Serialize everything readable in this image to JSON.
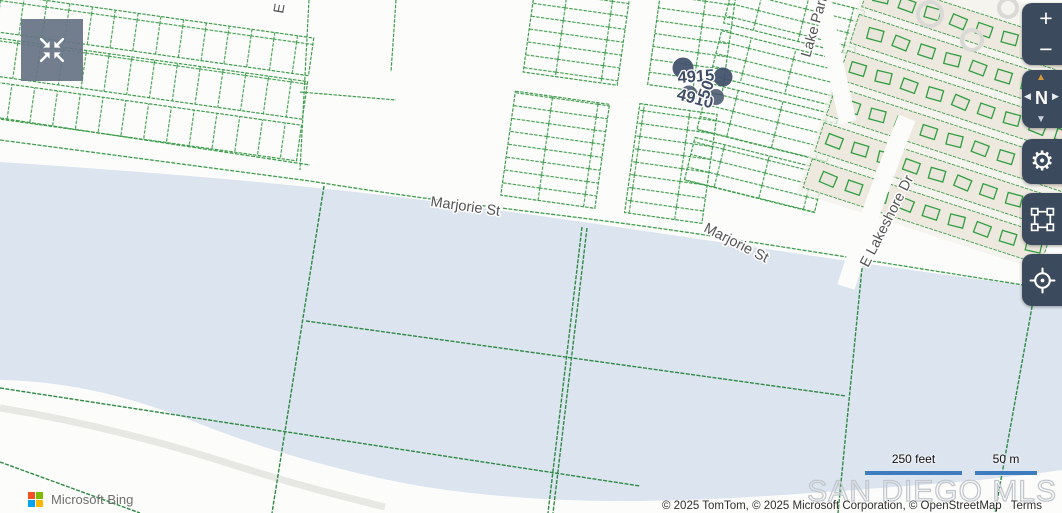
{
  "branding": {
    "provider_label": "Microsoft Bing",
    "watermark": "SAN DIEGO MLS"
  },
  "attribution": {
    "copyright": "© 2025 TomTom, © 2025 Microsoft Corporation, © OpenStreetMap",
    "terms_label": "Terms"
  },
  "scalebar": {
    "imperial": "250 feet",
    "metric": "50 m"
  },
  "map": {
    "street_labels": {
      "marjorie_west": "Marjorie St",
      "marjorie_east": "Marjorie St",
      "lake_park": "Lake Park",
      "lakeshore": "E Lakeshore Dr",
      "partial_top": "E"
    },
    "parcel_labels": {
      "a": "4915",
      "b": "4910",
      "c": "50"
    }
  },
  "controls": {
    "zoom_in_label": "+",
    "zoom_out_label": "−",
    "compass_label": "N"
  },
  "colors": {
    "parcel_line": "#3f9e4e",
    "water": "#dce4ef",
    "control_bg": "#3c4a5d",
    "scale_bar": "#3e7cc0",
    "compass_arrow": "#d59a3b",
    "marker_pin": "#42506a"
  }
}
